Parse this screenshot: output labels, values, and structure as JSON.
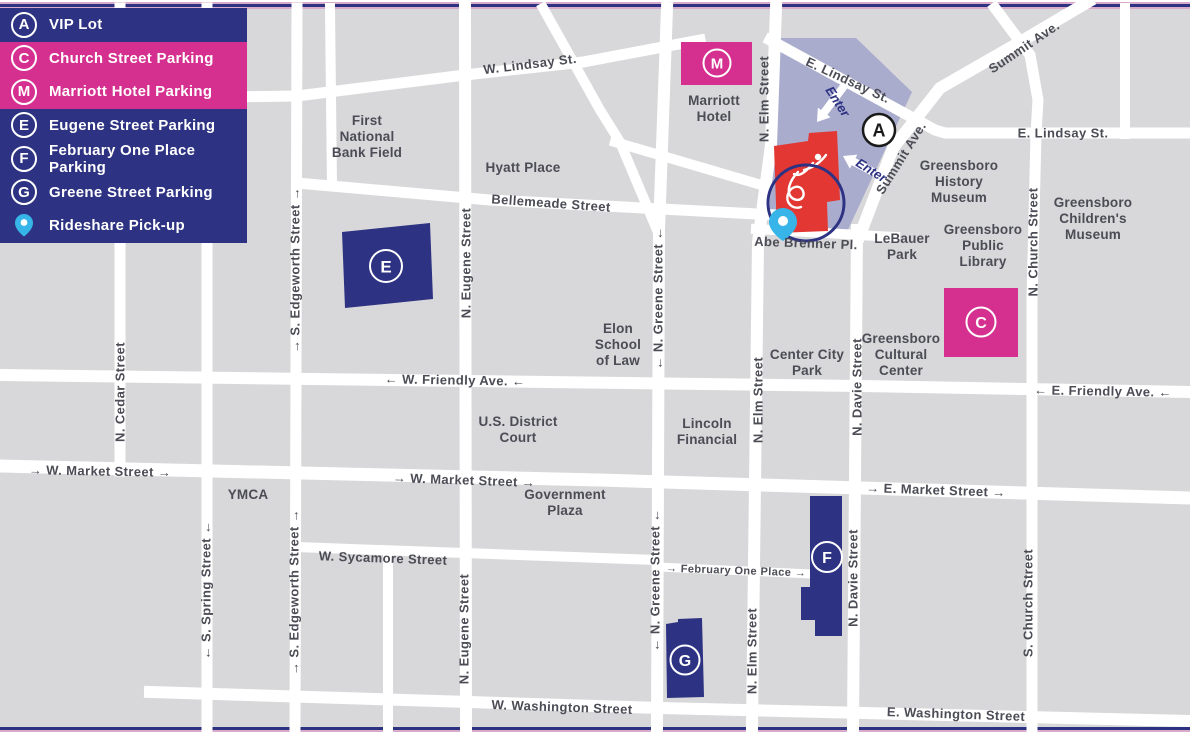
{
  "legend": {
    "items": [
      {
        "marker": "A",
        "label": "VIP Lot",
        "highlight": false
      },
      {
        "marker": "C",
        "label": "Church Street Parking",
        "highlight": true
      },
      {
        "marker": "M",
        "label": "Marriott Hotel Parking",
        "highlight": true
      },
      {
        "marker": "E",
        "label": "Eugene Street Parking",
        "highlight": false
      },
      {
        "marker": "F",
        "label": "February One Place Parking",
        "highlight": false
      },
      {
        "marker": "G",
        "label": "Greene Street Parking",
        "highlight": false
      },
      {
        "marker": "rideshare-pin",
        "label": "Rideshare Pick-up",
        "highlight": false
      }
    ]
  },
  "colors": {
    "navy": "#2d3282",
    "pink": "#d5308f",
    "lavender": "#a9accd",
    "venue_red": "#e23733",
    "map_gray": "#d8d8da",
    "street_white": "#ffffff",
    "label_gray": "#4b4c55",
    "pin_blue": "#38b5e8"
  },
  "map": {
    "enter_label": "Enter",
    "markers": {
      "a": "A",
      "c": "C",
      "m": "M",
      "e": "E",
      "f": "F",
      "g": "G"
    },
    "street_labels": [
      {
        "text": "N. Cedar Street",
        "x": 120,
        "y": 392,
        "vertical": true
      },
      {
        "text": "← S. Spring Street ←",
        "x": 206,
        "y": 590,
        "vertical": true
      },
      {
        "text": "→ S. Edgeworth Street →",
        "x": 295,
        "y": 270,
        "vertical": true
      },
      {
        "text": "→ S. Edgeworth Street →",
        "x": 294,
        "y": 592,
        "vertical": true
      },
      {
        "text": "N. Eugene Street",
        "x": 466,
        "y": 263,
        "vertical": true
      },
      {
        "text": "N. Eugene Street",
        "x": 464,
        "y": 629,
        "vertical": true
      },
      {
        "text": "← N. Greene Street ←",
        "x": 658,
        "y": 298,
        "vertical": true
      },
      {
        "text": "← N. Greene Street ←",
        "x": 655,
        "y": 580,
        "vertical": true
      },
      {
        "text": "N. Elm Street",
        "x": 764,
        "y": 99,
        "vertical": true
      },
      {
        "text": "N. Elm Street",
        "x": 758,
        "y": 400,
        "vertical": true
      },
      {
        "text": "N. Elm Street",
        "x": 752,
        "y": 651,
        "vertical": true
      },
      {
        "text": "N. Davie Street",
        "x": 857,
        "y": 387,
        "vertical": true
      },
      {
        "text": "N. Davie Street",
        "x": 853,
        "y": 578,
        "vertical": true
      },
      {
        "text": "N. Church Street",
        "x": 1033,
        "y": 242,
        "vertical": true
      },
      {
        "text": "S. Church Street",
        "x": 1028,
        "y": 603,
        "vertical": true
      },
      {
        "text": "W. Lindsay St.",
        "x": 530,
        "y": 64,
        "rot": -7
      },
      {
        "text": "E. Lindsay St.",
        "x": 848,
        "y": 80,
        "rot": 25
      },
      {
        "text": "Summit Ave.",
        "x": 1024,
        "y": 47,
        "rot": -34
      },
      {
        "text": "E. Lindsay St.",
        "x": 1063,
        "y": 133,
        "rot": 0
      },
      {
        "text": "Summit Ave.",
        "x": 901,
        "y": 158,
        "rot": -58
      },
      {
        "text": "Bellemeade Street",
        "x": 551,
        "y": 203,
        "rot": 4
      },
      {
        "text": "Abe Brenner Pl.",
        "x": 806,
        "y": 243,
        "rot": 2
      },
      {
        "text": "← W. Friendly Ave. ←",
        "x": 455,
        "y": 380,
        "rot": 1
      },
      {
        "text": "← E. Friendly Ave. ←",
        "x": 1103,
        "y": 391,
        "rot": 1
      },
      {
        "text": "→ W. Market Street →",
        "x": 100,
        "y": 471,
        "rot": 1
      },
      {
        "text": "→ W. Market Street →",
        "x": 464,
        "y": 480,
        "rot": 2
      },
      {
        "text": "→ E. Market Street →",
        "x": 936,
        "y": 490,
        "rot": 2
      },
      {
        "text": "W. Sycamore Street",
        "x": 383,
        "y": 558,
        "rot": 2
      },
      {
        "text": "→ February One Place →",
        "x": 736,
        "y": 571,
        "rot": 2,
        "size": 11
      },
      {
        "text": "W. Washington Street",
        "x": 562,
        "y": 707,
        "rot": 2
      },
      {
        "text": "E. Washington Street",
        "x": 956,
        "y": 714,
        "rot": 2
      }
    ],
    "place_labels": [
      {
        "lines": [
          "First",
          "National",
          "Bank Field"
        ],
        "x": 367,
        "y": 137
      },
      {
        "lines": [
          "Hyatt Place"
        ],
        "x": 523,
        "y": 168
      },
      {
        "lines": [
          "Marriott",
          "Hotel"
        ],
        "x": 714,
        "y": 109
      },
      {
        "lines": [
          "Greensboro",
          "History",
          "Museum"
        ],
        "x": 959,
        "y": 182
      },
      {
        "lines": [
          "Greensboro",
          "Children's",
          "Museum"
        ],
        "x": 1093,
        "y": 219
      },
      {
        "lines": [
          "LeBauer",
          "Park"
        ],
        "x": 902,
        "y": 247
      },
      {
        "lines": [
          "Greensboro",
          "Public",
          "Library"
        ],
        "x": 983,
        "y": 246
      },
      {
        "lines": [
          "Greensboro",
          "Cultural",
          "Center"
        ],
        "x": 901,
        "y": 355
      },
      {
        "lines": [
          "Center City",
          "Park"
        ],
        "x": 807,
        "y": 363
      },
      {
        "lines": [
          "Elon",
          "School",
          "of Law"
        ],
        "x": 618,
        "y": 345
      },
      {
        "lines": [
          "U.S. District",
          "Court"
        ],
        "x": 518,
        "y": 430
      },
      {
        "lines": [
          "Lincoln",
          "Financial"
        ],
        "x": 707,
        "y": 432
      },
      {
        "lines": [
          "YMCA"
        ],
        "x": 248,
        "y": 495
      },
      {
        "lines": [
          "Government",
          "Plaza"
        ],
        "x": 565,
        "y": 503
      }
    ]
  }
}
